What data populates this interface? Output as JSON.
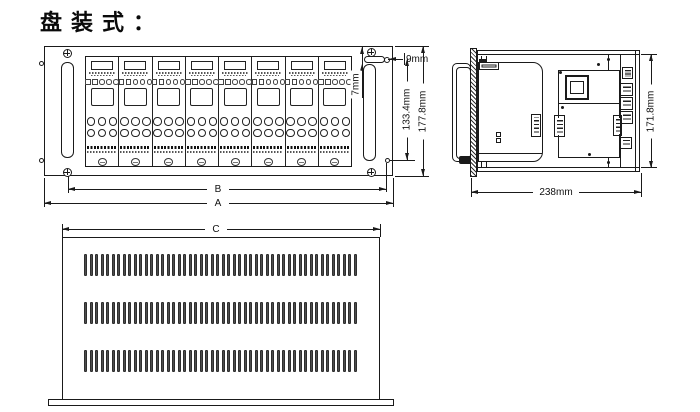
{
  "title": "盘装式：",
  "colors": {
    "line": "#1a1a1a",
    "background": "#ffffff",
    "slot_fill": "#4d4d4d"
  },
  "front_view": {
    "module_count": 8,
    "dims": {
      "offset_h": "9mm",
      "offset_v": "7mm",
      "inner_height": "133.4mm",
      "outer_height": "177.8mm",
      "outer_width": "A",
      "inner_width": "B"
    }
  },
  "side_view": {
    "dims": {
      "height": "171.8mm",
      "depth": "238mm"
    }
  },
  "bottom_view": {
    "vent_rows": 3,
    "slots_per_row": 50,
    "dims": {
      "width": "C"
    }
  }
}
